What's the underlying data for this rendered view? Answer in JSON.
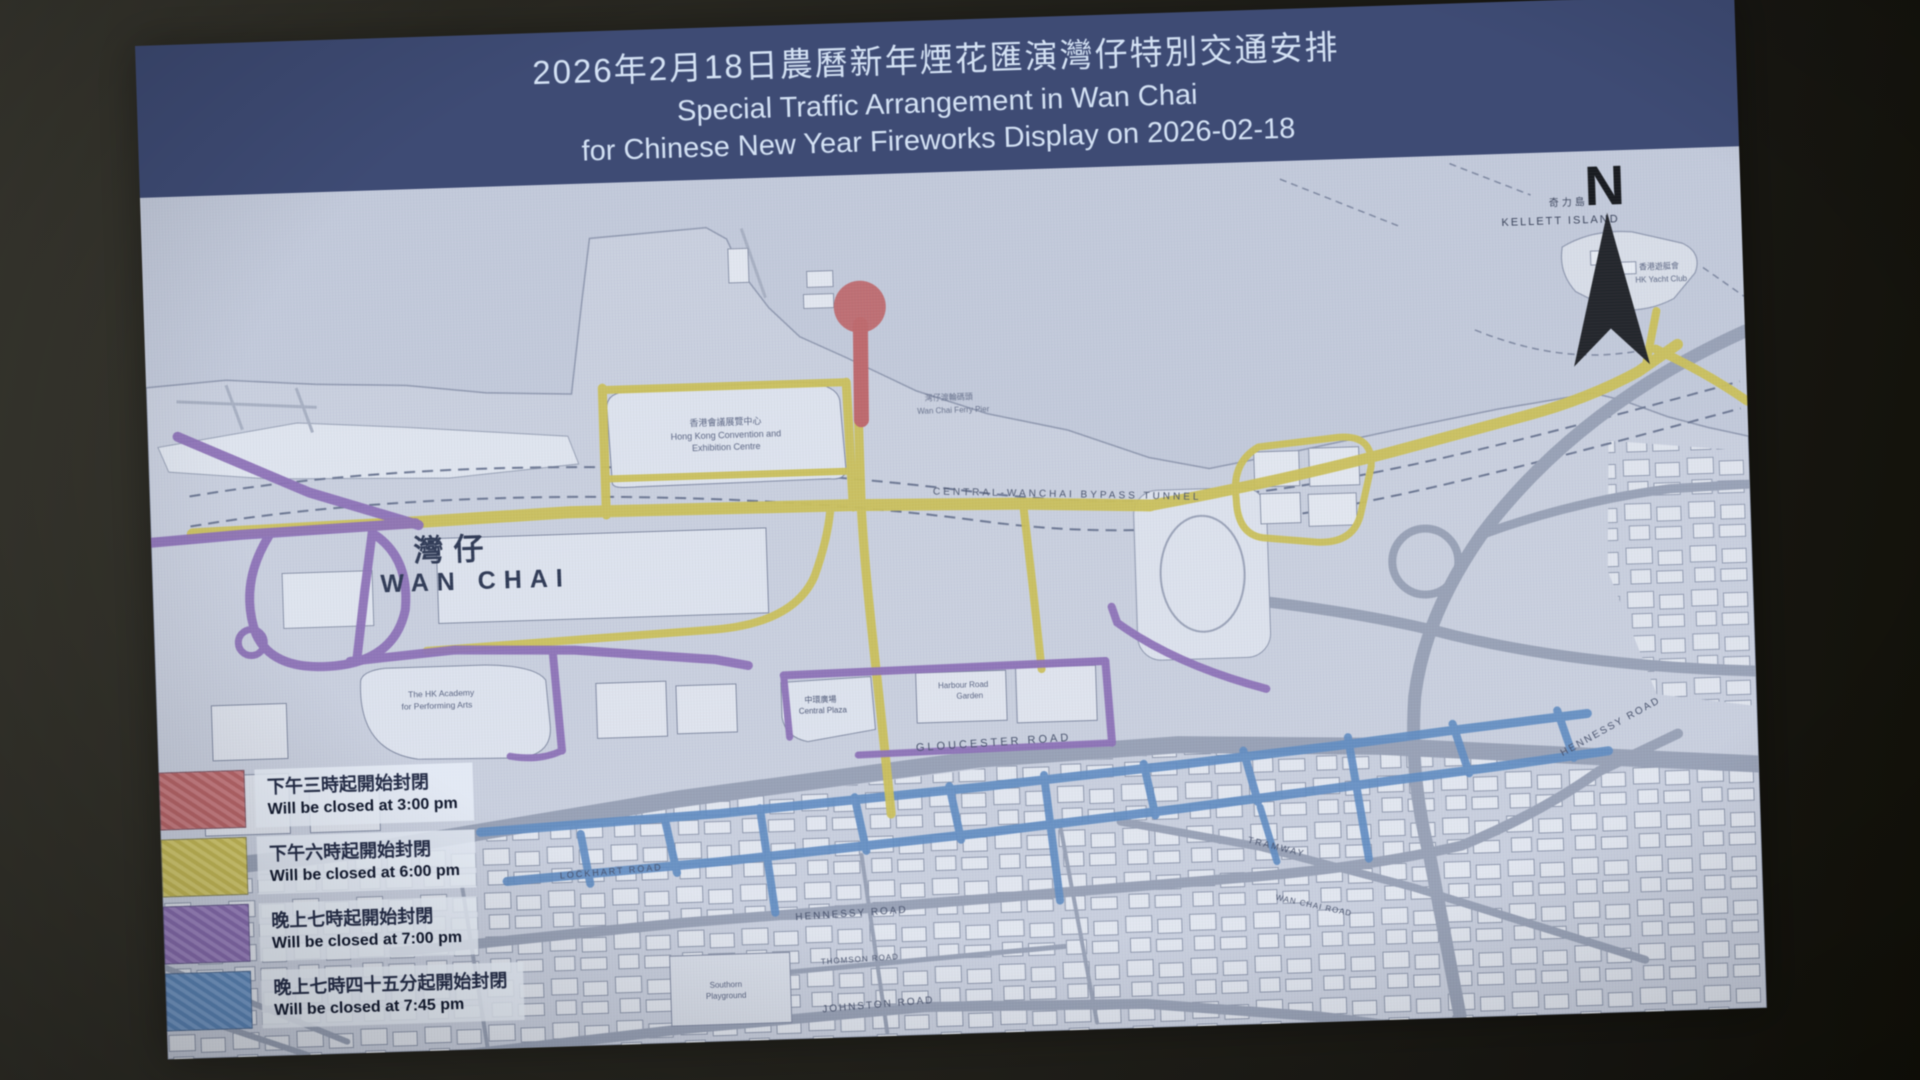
{
  "header": {
    "line1_zh": "2026年2月18日農曆新年煙花匯演灣仔特別交通安排",
    "line2_en": "Special Traffic Arrangement in Wan Chai",
    "line3_en": "for Chinese New Year Fireworks Display on 2026-02-18",
    "bg_color": "#3d4b78",
    "text_color": "#d3e2f6"
  },
  "legend": {
    "items": [
      {
        "zh": "下午三時起開始封閉",
        "en": "Will be closed at 3:00 pm",
        "color": "#c4686d"
      },
      {
        "zh": "下午六時起開始封閉",
        "en": "Will be closed at 6:00 pm",
        "color": "#cdc153"
      },
      {
        "zh": "晚上七時起開始封閉",
        "en": "Will be closed at 7:00 pm",
        "color": "#8f72bd"
      },
      {
        "zh": "晚上七時四十五分起開始封閉",
        "en": "Will be closed at 7:45 pm",
        "color": "#5f8ec8"
      }
    ]
  },
  "compass": {
    "label": "N"
  },
  "map": {
    "labels": {
      "wanchai_zh": "灣仔",
      "wanchai_en": "WAN CHAI",
      "hkcec_zh": "香港會議展覽中心",
      "hkcec_en1": "Hong Kong Convention and",
      "hkcec_en2": "Exhibition Centre",
      "bypass": "CENTRAL-WANCHAI BYPASS TUNNEL",
      "gloucester": "GLOUCESTER ROAD",
      "lockhart": "LOCKHART ROAD",
      "hennessy": "HENNESSY ROAD",
      "hennessy_e": "HENNESSY ROAD",
      "thomson": "THOMSON ROAD",
      "johnston": "JOHNSTON ROAD",
      "tramway": "TRAMWAY",
      "wanchai_rd": "WAN CHAI ROAD",
      "kellett_zh": "奇力島",
      "kellett_en": "KELLETT ISLAND",
      "yacht_zh": "香港遊艇會",
      "yacht_en": "HK Yacht Club",
      "ferry_zh": "灣仔渡輪碼頭",
      "ferry_en": "Wan Chai Ferry Pier",
      "central_plaza_zh": "中環廣場",
      "central_plaza_en": "Central Plaza",
      "harbour_garden1": "Harbour Road",
      "harbour_garden2": "Garden",
      "apa1": "The HK Academy",
      "apa2": "for Performing Arts",
      "southorn1": "Southorn",
      "southorn2": "Playground"
    },
    "road_colors": {
      "closed_3pm": "#c4686d",
      "closed_6pm": "#cdc153",
      "closed_7pm": "#8f72bd",
      "closed_745pm": "#5f8ec8",
      "open_road": "#98a2b8"
    }
  }
}
